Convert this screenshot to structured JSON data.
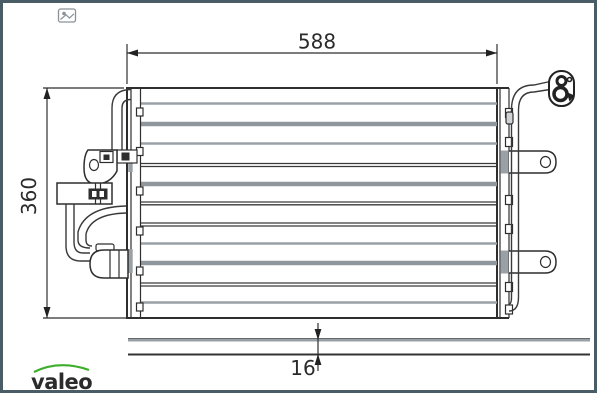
{
  "drawing": {
    "type": "technical-drawing-condenser",
    "dimensions": {
      "width": {
        "label": "588"
      },
      "height": {
        "label": "360"
      },
      "depth": {
        "label": "16"
      }
    }
  },
  "branding": {
    "logo_text": "valeo",
    "logo_color": "#3dae2b"
  },
  "colors": {
    "frame_border": "#4a5d66",
    "line": "#2e2e2e",
    "tube_gray": "#9aa1a6",
    "background": "#ffffff"
  },
  "icons": {
    "corner_marker": "image-marker-icon"
  }
}
